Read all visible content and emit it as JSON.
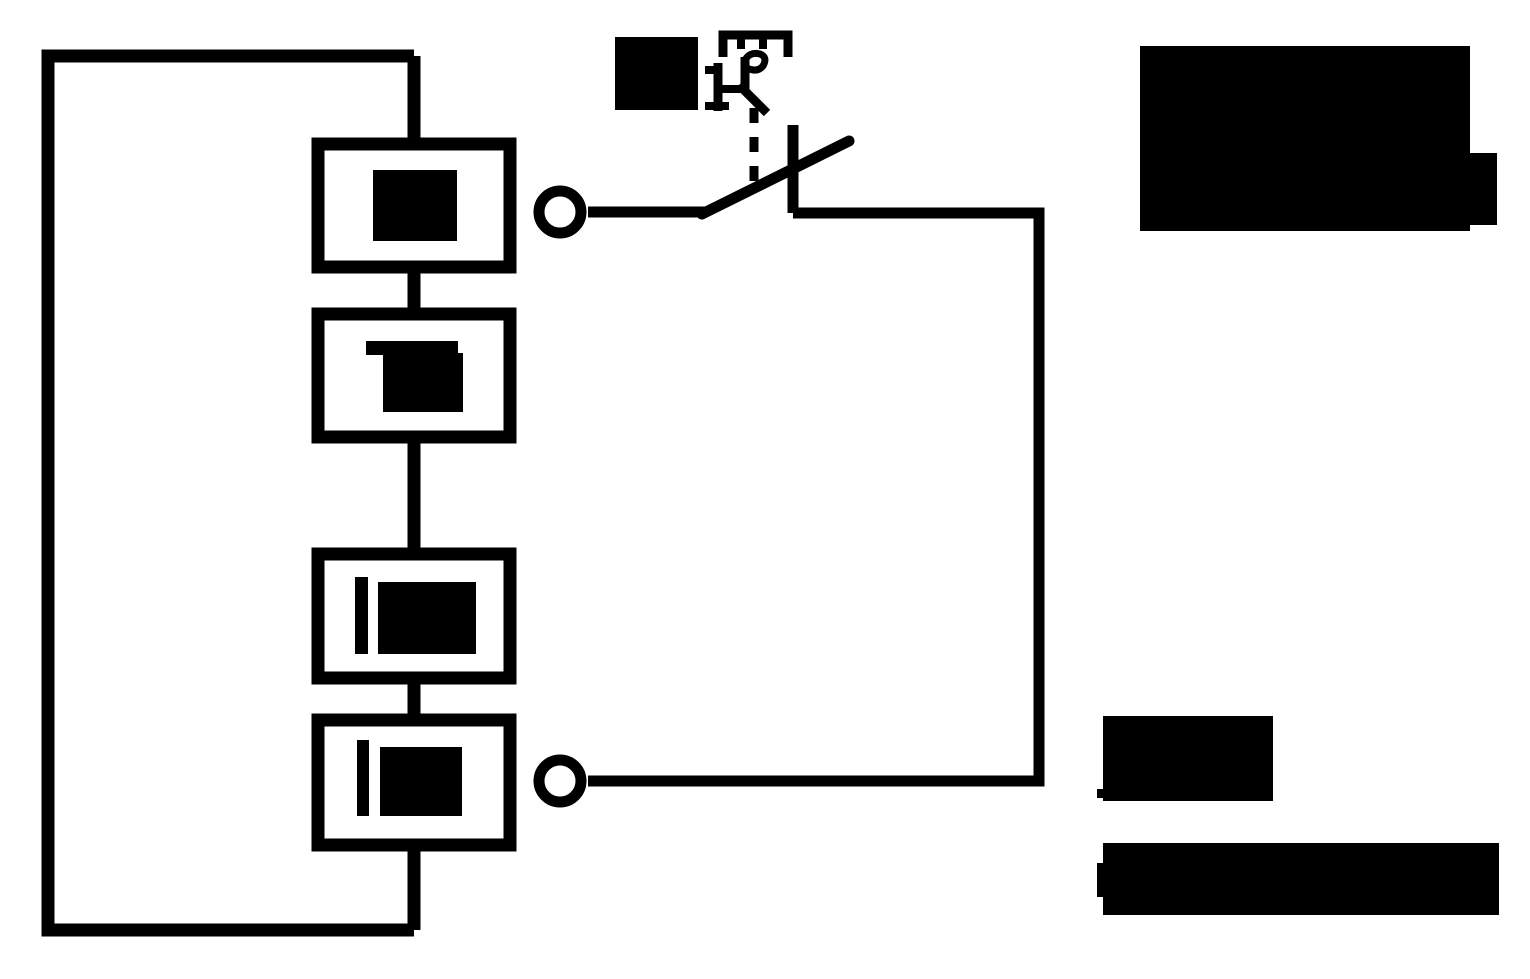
{
  "canvas": {
    "width": 1530,
    "height": 979,
    "background": "#ffffff",
    "ink": "#000000"
  },
  "diagram": {
    "type": "circuit-schematic",
    "description": "Closed outer wiring loop on the left feeding four series component boxes; every text label is redacted with solid black blocks. Two circle terminals connect the box column to an external branch containing a contact switch with a dashed mechanical linkage up to an actuator symbol. Large black redaction blocks cover the annotation text at top right and bottom right.",
    "wires": {
      "outer_loop": "M414,56 H48 V930 H414",
      "spine": "M414,56 V930",
      "switch_feed": "M588,212 H705",
      "contact_post": "M793,125 V213",
      "route": "M793,213 H1039 V781 H588",
      "blade": "M702,214 L849,141",
      "linkage": "M754,108 V186"
    },
    "boxes": [
      {
        "x": 318,
        "y": 144,
        "w": 192,
        "h": 123
      },
      {
        "x": 318,
        "y": 314,
        "w": 192,
        "h": 123
      },
      {
        "x": 318,
        "y": 554,
        "w": 192,
        "h": 124
      },
      {
        "x": 318,
        "y": 720,
        "w": 192,
        "h": 125
      }
    ],
    "terminals": [
      {
        "cx": 560,
        "cy": 212,
        "r": 21
      },
      {
        "cx": 560,
        "cy": 781,
        "r": 21
      }
    ],
    "actuator": {
      "bracket": "M723,57 V35 H788 V57",
      "tooth_left": "M741,39 V49",
      "tooth_right": "M763,39 V49",
      "stem": "M718,63 V111",
      "serif_top": "M705,70 H719",
      "foot": "M705,106 H729",
      "crossbar": "M721,89 H744",
      "right_stem": "M745,57 V91",
      "curl": "M744,62 Q749,51 760,54 Q768,57 763,66 Q757,73 747,68",
      "leg": "M739,85 L767,113"
    },
    "redactions": [
      {
        "name": "box1-label",
        "x": 373,
        "y": 170,
        "w": 84,
        "h": 71
      },
      {
        "name": "box2-label-top",
        "x": 366,
        "y": 341,
        "w": 92,
        "h": 14
      },
      {
        "name": "box2-label-main",
        "x": 383,
        "y": 353,
        "w": 80,
        "h": 59
      },
      {
        "name": "box3-label-bar",
        "x": 355,
        "y": 577,
        "w": 13,
        "h": 77
      },
      {
        "name": "box3-label-main",
        "x": 378,
        "y": 582,
        "w": 98,
        "h": 72
      },
      {
        "name": "box4-label-bar",
        "x": 357,
        "y": 740,
        "w": 12,
        "h": 76
      },
      {
        "name": "box4-label-main",
        "x": 380,
        "y": 747,
        "w": 82,
        "h": 69
      },
      {
        "name": "switch-label",
        "x": 615,
        "y": 37,
        "w": 83,
        "h": 73
      },
      {
        "name": "note-top-right-main",
        "x": 1140,
        "y": 46,
        "w": 330,
        "h": 185
      },
      {
        "name": "note-top-right-tab",
        "x": 1468,
        "y": 153,
        "w": 29,
        "h": 72
      },
      {
        "name": "note-bottom-line1",
        "x": 1103,
        "y": 716,
        "w": 170,
        "h": 85
      },
      {
        "name": "note-bottom-line1-tick",
        "x": 1097,
        "y": 789,
        "w": 7,
        "h": 9
      },
      {
        "name": "note-bottom-line2",
        "x": 1103,
        "y": 843,
        "w": 396,
        "h": 72
      },
      {
        "name": "note-bottom-line2-tick",
        "x": 1097,
        "y": 863,
        "w": 7,
        "h": 34
      }
    ]
  }
}
